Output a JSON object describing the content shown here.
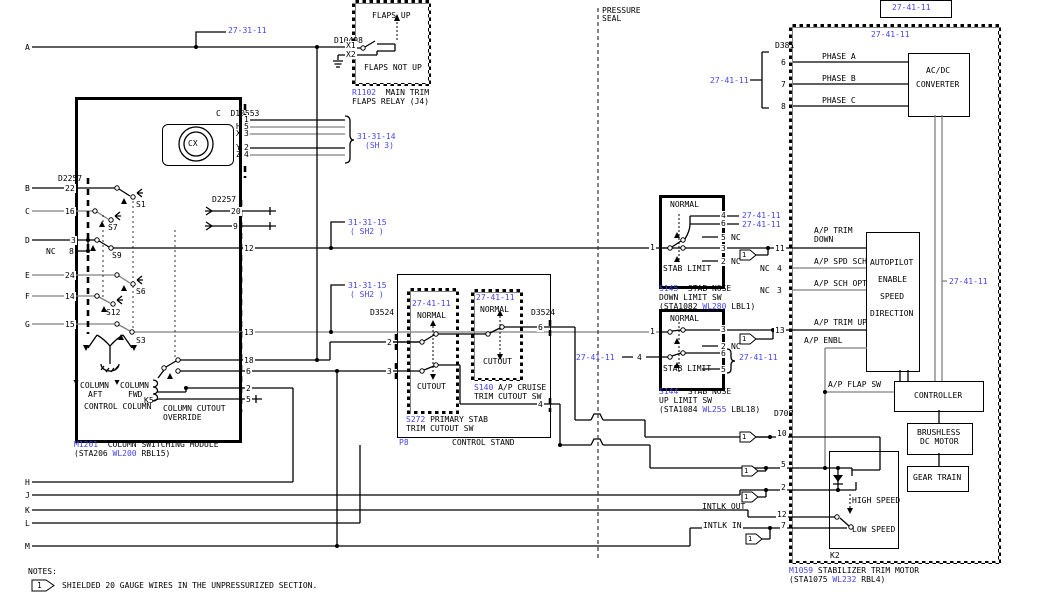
{
  "colors": {
    "ref_blue": "#4444ee",
    "wire_gray": "#808080",
    "black": "#000000"
  },
  "row_letters": [
    "A",
    "B",
    "C",
    "D",
    "E",
    "F",
    "G",
    "H",
    "J",
    "K",
    "L",
    "M"
  ],
  "refs": {
    "r27_31_11": "27-31-11",
    "r27_41_11": "27-41-11",
    "r31_31_14": "31-31-14",
    "sh3": "(SH 3)",
    "r31_31_15": "31-31-15",
    "sh2": "( SH2 )"
  },
  "flaps_relay": {
    "conn": "D10498",
    "x1": "X1",
    "x2": "X2",
    "up": "FLAPS UP",
    "not_up": "FLAPS NOT UP",
    "id": "R1102",
    "name1": "  MAIN TRIM",
    "name2": "FLAPS RELAY (J4)"
  },
  "drum": {
    "conn": "C  D10553",
    "cx": "CX",
    "pin_letters": [
      "H",
      "X",
      "Y",
      "Z"
    ],
    "pins": [
      "1",
      "5",
      "3",
      "2",
      "4"
    ]
  },
  "module": {
    "conn_left": "D2257",
    "conn_right": "D2257",
    "pins_left": [
      "22",
      "16",
      "3",
      "8",
      "24",
      "14",
      "15"
    ],
    "nc": "NC",
    "switches": [
      "S1",
      "S7",
      "S9",
      "S6",
      "S12",
      "S3"
    ],
    "pass_pins": [
      "20",
      "9"
    ],
    "pins_right": [
      "12",
      "13",
      "18",
      "6",
      "2",
      "5"
    ],
    "column": "COLUMN",
    "aft": "AFT",
    "fwd": "FWD",
    "control_column": "CONTROL COLUMN",
    "k5": "K5",
    "cutout1": "COLUMN CUTOUT",
    "cutout2": "OVERRIDE",
    "id": "M1201",
    "name": "  COLUMN SWITCHING MODULE",
    "loc1": "(STA206 ",
    "loc_wl": "WL200",
    "loc2": " RBL15)"
  },
  "control_stand": {
    "conn_left": "D3524",
    "conn_right": "D3524",
    "pin2": "2",
    "pin3": "3",
    "pin6": "6",
    "pin4": "4",
    "normal": "NORMAL",
    "cutout": "CUTOUT",
    "s272_id": "S272",
    "s272_name1": " PRIMARY STAB",
    "s272_name2": "TRIM CUTOUT SW",
    "s140_id": "S140",
    "s140_name1": " A/P CRUISE",
    "s140_name2": "TRIM CUTOUT SW",
    "p8": "P8",
    "name": "CONTROL STAND"
  },
  "seal": {
    "l1": "PRESSURE",
    "l2": "SEAL"
  },
  "s145": {
    "normal": "NORMAL",
    "stab_limit": "STAB LIMIT",
    "p1": "1",
    "p4": "4",
    "p6": "6",
    "p5": "5",
    "p3": "3",
    "p2": "2",
    "nc": "NC",
    "id": "S145",
    "name1": "  STAB NOSE",
    "name2": "DOWN LIMIT SW",
    "loc1": "(STA1082 ",
    "loc_wl": "WL280",
    "loc2": " LBL1)"
  },
  "s144": {
    "normal": "NORMAL",
    "stab_limit": "STAB LIMIT",
    "p1": "1",
    "p3": "3",
    "p2": "2",
    "p6": "6",
    "p5": "5",
    "p4": "4",
    "nc": "NC",
    "id": "S144",
    "name1": "  STAB NOSE",
    "name2": "UP LIMIT SW",
    "loc1": "(STA1084 ",
    "loc_wl": "WL255",
    "loc2": " LBL18)"
  },
  "motor": {
    "conn_top": "D381",
    "phase_pins": [
      "6",
      "7",
      "8"
    ],
    "phases": [
      "PHASE A",
      "PHASE B",
      "PHASE C"
    ],
    "acdc1": "AC/DC",
    "acdc2": "CONVERTER",
    "ap_trim": "A/P TRIM",
    "down": "DOWN",
    "p11": "11",
    "nc": "NC",
    "p4": "4",
    "ap_spd": "A/P SPD SCH",
    "p3": "3",
    "ap_sch": "A/P SCH OPT",
    "autopilot": [
      "AUTOPILOT",
      "ENABLE",
      "SPEED",
      "DIRECTION"
    ],
    "p13": "13",
    "ap_trim_up": "A/P TRIM UP",
    "ap_enbl": "A/P ENBL",
    "ap_flap": "A/P FLAP SW",
    "controller": "CONTROLLER",
    "brushless1": "BRUSHLESS",
    "brushless2": "DC MOTOR",
    "gear": "GEAR TRAIN",
    "conn_right": "D708",
    "p10": "10",
    "p5": "5",
    "p2": "2",
    "p12": "12",
    "p7": "7",
    "intlk_out": "INTLK OUT",
    "intlk_in": "INTLK IN",
    "high": "HIGH SPEED",
    "low": "LOW SPEED",
    "k2": "K2",
    "id": "M1059",
    "name": " STABILIZER TRIM MOTOR",
    "loc1": "(STA1075 ",
    "loc_wl": "WL232",
    "loc2": " RBL4)"
  },
  "notes": {
    "title": "NOTES:",
    "flag": "1",
    "note1": "SHIELDED 20 GAUGE WIRES IN THE UNPRESSURIZED SECTION."
  }
}
